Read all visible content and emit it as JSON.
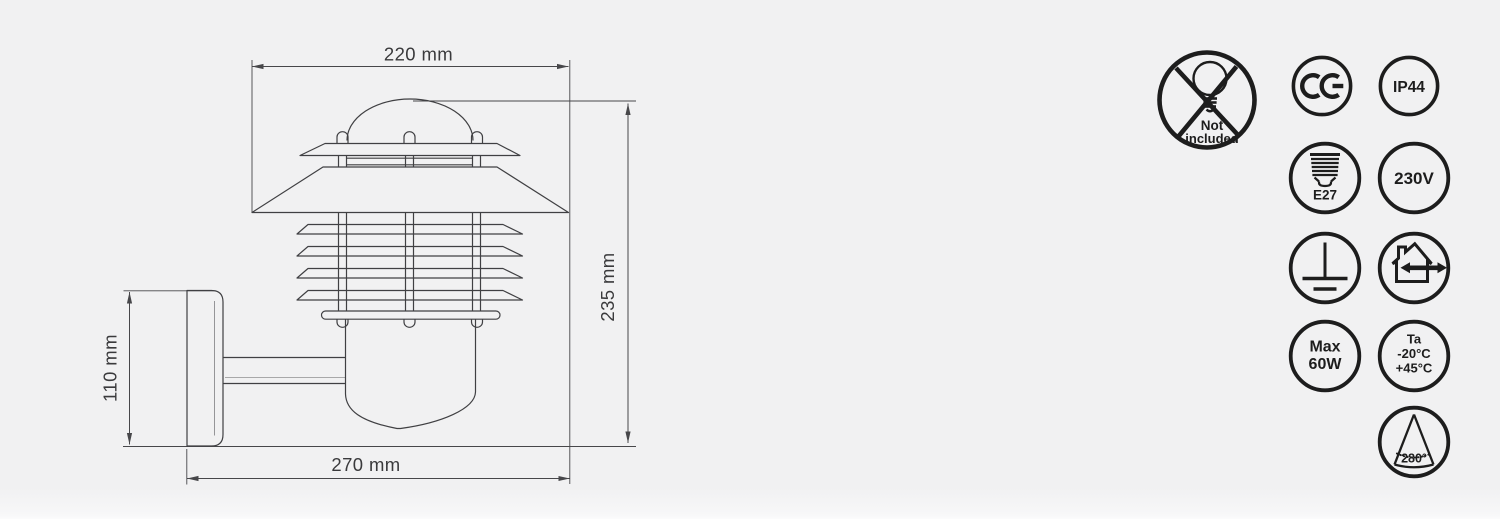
{
  "page": {
    "background": "#f1f1f2"
  },
  "drawing": {
    "width_top": "220 mm",
    "height_right": "235 mm",
    "height_left": "110 mm",
    "width_bottom": "270 mm"
  },
  "badges": {
    "not_included": {
      "line1": "Not",
      "line2": "included"
    },
    "ce": {
      "label": "CE"
    },
    "ip_rating": {
      "label": "IP44"
    },
    "socket": {
      "label": "E27"
    },
    "voltage": {
      "label": "230V"
    },
    "earth": {
      "label": "protective-earth"
    },
    "indoor_outdoor": {
      "label": "indoor-outdoor-use"
    },
    "max_power": {
      "line1": "Max",
      "line2": "60W"
    },
    "ambient_temp": {
      "line1": "Ta",
      "line2": "-20°C",
      "line3": "+45°C"
    },
    "beam_angle": {
      "label": "280°"
    }
  }
}
